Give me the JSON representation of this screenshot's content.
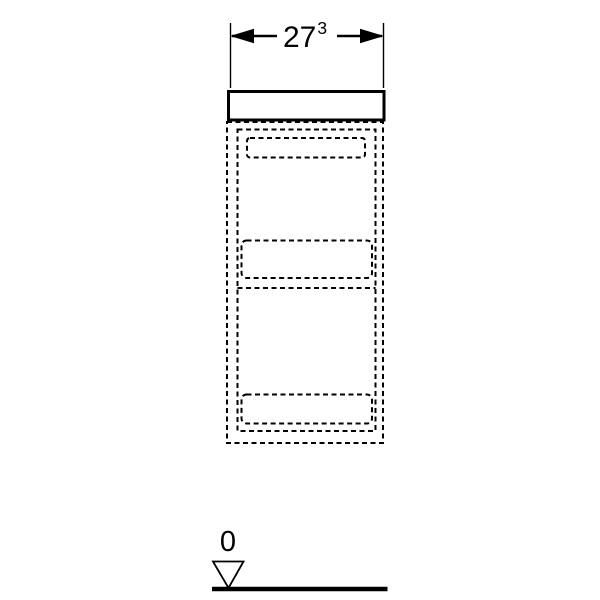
{
  "dimension": {
    "value": "27",
    "superscript": "3",
    "full_label": "27³"
  },
  "datum": {
    "label": "0"
  },
  "colors": {
    "line": "#000000",
    "background": "#ffffff"
  },
  "icons": {
    "dimension-arrowhead-left-icon": "◀",
    "dimension-arrowhead-right-icon": "▶",
    "datum-triangle-icon": "▽"
  }
}
